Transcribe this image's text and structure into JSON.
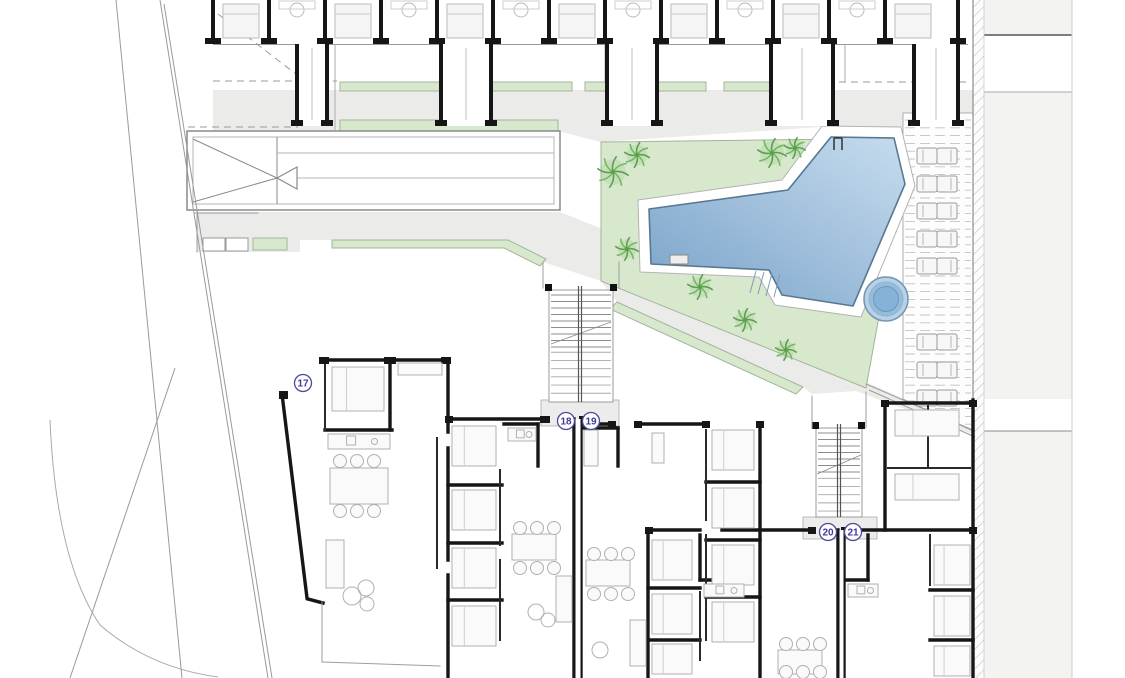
{
  "plan": {
    "title": "site-floor-plan",
    "unit_labels": [
      {
        "text": "17",
        "x": 303,
        "y": 383
      },
      {
        "text": "18",
        "x": 566,
        "y": 421
      },
      {
        "text": "19",
        "x": 591,
        "y": 421
      },
      {
        "text": "20",
        "x": 828,
        "y": 532
      },
      {
        "text": "21",
        "x": 853,
        "y": 532
      }
    ],
    "palette": {
      "plaza": "#ebebe9",
      "green": "#d7e8cd",
      "greenEdge": "#a3b49c",
      "poolDark": "#79a2c9",
      "poolLight": "#c6dcee",
      "poolEdge": "#587891",
      "spaFill": "#b7d2e7",
      "spaMid": "#95bcda",
      "spaCore": "#86b2d8",
      "spaEdge": "#7396b2",
      "wall": "#161616",
      "wallMed": "#2a2a2a",
      "furn": "#b0b0b0",
      "light": "#9e9e9e",
      "hatch": "#c4c4c4",
      "panel": "#f3f3f1",
      "labelInk": "#3c3c96",
      "labelRing": "#4949a0",
      "palm": "#74b862",
      "palmDark": "#5d9e4f",
      "dash": "#9a9a9a",
      "deckLine": "#c2c2c2"
    },
    "plaza_polys": [
      [
        [
          213,
          90
        ],
        [
          973,
          90
        ],
        [
          973,
          113
        ],
        [
          903,
          113
        ],
        [
          903,
          127
        ],
        [
          820,
          127
        ],
        [
          601,
          142
        ],
        [
          558,
          131
        ],
        [
          558,
          120
        ],
        [
          340,
          120
        ],
        [
          340,
          131
        ],
        [
          213,
          131
        ]
      ],
      [
        [
          197,
          212
        ],
        [
          560,
          212
        ],
        [
          610,
          232
        ],
        [
          868,
          383
        ],
        [
          972,
          428
        ],
        [
          972,
          434
        ],
        [
          856,
          391
        ],
        [
          812,
          394
        ],
        [
          803,
          387
        ],
        [
          617,
          302
        ],
        [
          601,
          281
        ],
        [
          543,
          262
        ],
        [
          508,
          248
        ],
        [
          332,
          240
        ],
        [
          300,
          240
        ],
        [
          300,
          252
        ],
        [
          197,
          252
        ]
      ]
    ],
    "green_polys": [
      [
        [
          601,
          142
        ],
        [
          850,
          139
        ],
        [
          882,
          300
        ],
        [
          866,
          388
        ],
        [
          601,
          281
        ]
      ],
      [
        [
          617,
          302
        ],
        [
          803,
          387
        ],
        [
          796,
          394
        ],
        [
          610,
          309
        ]
      ],
      [
        [
          332,
          240
        ],
        [
          508,
          240
        ],
        [
          546,
          259
        ],
        [
          540,
          266
        ],
        [
          504,
          248
        ],
        [
          332,
          248
        ]
      ]
    ],
    "green_rects": [
      [
        253,
        238,
        34,
        12
      ],
      [
        340,
        82,
        100,
        9
      ],
      [
        462,
        82,
        110,
        9
      ],
      [
        585,
        82,
        121,
        9
      ],
      [
        724,
        82,
        54,
        9
      ],
      [
        340,
        120,
        218,
        11
      ]
    ],
    "ramp": {
      "outer": [
        187,
        131,
        373,
        79
      ],
      "inner": [
        193,
        137,
        361,
        67
      ],
      "vline": 277,
      "hlines": [
        153,
        178
      ],
      "tri": [
        [
          193,
          139
        ],
        [
          277,
          178
        ],
        [
          193,
          202
        ]
      ],
      "arrow": [
        [
          277,
          178
        ],
        [
          297,
          167
        ],
        [
          297,
          189
        ]
      ]
    },
    "park_rects": [
      [
        203,
        238,
        22,
        13
      ],
      [
        226,
        238,
        22,
        13
      ]
    ],
    "pool": {
      "apron": [
        [
          822,
          126
        ],
        [
          901,
          127
        ],
        [
          915,
          186
        ],
        [
          861,
          317
        ],
        [
          775,
          305
        ],
        [
          759,
          277
        ],
        [
          640,
          272
        ],
        [
          638,
          200
        ],
        [
          782,
          180
        ]
      ],
      "body": [
        [
          831,
          137
        ],
        [
          894,
          138
        ],
        [
          905,
          184
        ],
        [
          853,
          306
        ],
        [
          782,
          295
        ],
        [
          769,
          270
        ],
        [
          651,
          264
        ],
        [
          649,
          209
        ],
        [
          788,
          190
        ]
      ],
      "steps": [
        [
          756,
          271,
          750,
          293
        ],
        [
          764,
          272,
          758,
          294
        ],
        [
          772,
          273,
          766,
          296
        ],
        [
          780,
          274,
          774,
          297
        ]
      ],
      "rail": {
        "x": 834,
        "y": 138,
        "w": 8,
        "h": 12
      },
      "bench": [
        670,
        255,
        18,
        9
      ]
    },
    "spa": {
      "cx": 886,
      "cy": 299,
      "r1": 22,
      "r2": 17,
      "r3": 12.5
    },
    "deck": {
      "poly": [
        [
          903,
          113
        ],
        [
          973,
          113
        ],
        [
          973,
          431
        ],
        [
          903,
          399
        ]
      ],
      "dashTop": 120,
      "dashBot": 428,
      "dashStep": 7.8,
      "loungerRows": [
        148,
        176,
        203,
        231,
        258,
        334,
        362,
        390
      ],
      "loungerX": 917
    },
    "hatch_strip": {
      "x": 973,
      "y": 0,
      "w": 11,
      "h": 678
    },
    "right_panel": {
      "x": 984,
      "w": 88,
      "whiteBands": [
        [
          35,
          57
        ],
        [
          399,
          32
        ]
      ],
      "lines": [
        {
          "y": 35,
          "x1": 975,
          "x2": 1072,
          "c": "#555",
          "w": 1.4
        },
        {
          "y": 92,
          "x1": 975,
          "x2": 1072,
          "c": "#aaa",
          "w": 1
        },
        {
          "y": 431,
          "x1": 975,
          "x2": 1072,
          "c": "#888",
          "w": 1
        }
      ],
      "vline": 1072
    },
    "boundaries": {
      "lines": [
        [
          116,
          0,
          182,
          678
        ],
        [
          160,
          0,
          268,
          678
        ],
        [
          164,
          4,
          272,
          678
        ],
        [
          175,
          368,
          70,
          678
        ],
        [
          866,
          384,
          975,
          431
        ],
        [
          869,
          390,
          975,
          437
        ]
      ],
      "curve": "M 50,420 Q 56,560 100,625 Q 150,668 218,677"
    },
    "dashed_lines": [
      [
        213,
        81,
        337,
        81
      ],
      [
        779,
        82,
        971,
        82
      ],
      [
        218,
        14,
        301,
        78
      ],
      [
        188,
        127,
        298,
        127
      ]
    ],
    "thin_vlines": [
      [
        335,
        44,
        131
      ],
      [
        455,
        44,
        82
      ],
      [
        605,
        44,
        82
      ],
      [
        788,
        44,
        120
      ],
      [
        845,
        44,
        82
      ]
    ],
    "top_row": {
      "wallXs": [
        213,
        269,
        325,
        381,
        437,
        493,
        549,
        605,
        661,
        717,
        773,
        829,
        885,
        958
      ],
      "wallTop": 0,
      "wallBot": 44,
      "cores": [
        {
          "x": 297,
          "w": 30
        },
        {
          "x": 441,
          "w": 50
        },
        {
          "x": 607,
          "w": 50
        },
        {
          "x": 771,
          "w": 62
        },
        {
          "x": 914,
          "w": 44
        }
      ],
      "coreBot": 126
    },
    "stairs": [
      {
        "x": 549,
        "y": 290,
        "w": 64,
        "h": 112,
        "railX": 580,
        "breakLine": [
          551,
          344,
          611,
          322
        ],
        "stubs": [
          [
            545,
            284
          ],
          [
            610,
            284
          ]
        ],
        "landing": [
          541,
          400,
          78,
          26
        ]
      },
      {
        "x": 816,
        "y": 428,
        "w": 46,
        "h": 89,
        "railX": 839,
        "breakLine": [
          817,
          474,
          861,
          455
        ],
        "stubs": [
          [
            812,
            422
          ],
          [
            858,
            422
          ]
        ],
        "landing": [
          803,
          517,
          74,
          22
        ]
      }
    ],
    "walls_heavy": [
      [
        323,
        360,
        448,
        360
      ],
      [
        448,
        360,
        448,
        432
      ],
      [
        390,
        362,
        390,
        430
      ],
      [
        325,
        430,
        392,
        430
      ],
      [
        282,
        394,
        307,
        598
      ],
      [
        308,
        599,
        323,
        603
      ],
      [
        448,
        448,
        448,
        560
      ],
      [
        448,
        575,
        448,
        678
      ],
      [
        448,
        419,
        545,
        419
      ],
      [
        538,
        424,
        538,
        466
      ],
      [
        504,
        424,
        538,
        424
      ],
      [
        448,
        485,
        502,
        485
      ],
      [
        448,
        543,
        502,
        543
      ],
      [
        448,
        600,
        502,
        600
      ],
      [
        574,
        419,
        574,
        678
      ],
      [
        581,
        419,
        581,
        678
      ],
      [
        582,
        424,
        612,
        424
      ],
      [
        638,
        424,
        706,
        424
      ],
      [
        618,
        428,
        618,
        466
      ],
      [
        582,
        428,
        618,
        428
      ],
      [
        706,
        482,
        760,
        482
      ],
      [
        706,
        540,
        760,
        540
      ],
      [
        706,
        597,
        760,
        597
      ],
      [
        760,
        424,
        760,
        678
      ],
      [
        648,
        530,
        700,
        530
      ],
      [
        722,
        530,
        812,
        530
      ],
      [
        845,
        530,
        973,
        530
      ],
      [
        648,
        530,
        648,
        678
      ],
      [
        838,
        530,
        838,
        678
      ],
      [
        844,
        530,
        844,
        678
      ],
      [
        973,
        400,
        973,
        678
      ],
      [
        885,
        403,
        973,
        403
      ],
      [
        885,
        403,
        885,
        530
      ],
      [
        700,
        535,
        700,
        580
      ],
      [
        700,
        580,
        740,
        580
      ],
      [
        648,
        588,
        700,
        588
      ],
      [
        648,
        640,
        700,
        640
      ],
      [
        868,
        535,
        868,
        580
      ],
      [
        845,
        580,
        868,
        580
      ],
      [
        930,
        590,
        973,
        590
      ],
      [
        930,
        640,
        973,
        640
      ]
    ],
    "walls_med": [
      [
        325,
        362,
        325,
        430
      ],
      [
        437,
        438,
        437,
        568
      ],
      [
        500,
        470,
        500,
        545
      ],
      [
        500,
        560,
        500,
        640
      ],
      [
        706,
        430,
        706,
        520
      ],
      [
        706,
        535,
        706,
        640
      ],
      [
        888,
        468,
        970,
        468
      ],
      [
        928,
        406,
        928,
        466
      ],
      [
        700,
        592,
        700,
        660
      ],
      [
        930,
        535,
        930,
        585
      ]
    ],
    "wall_stubs": [
      [
        319,
        357,
        10,
        7
      ],
      [
        384,
        357,
        12,
        7
      ],
      [
        441,
        357,
        10,
        7
      ],
      [
        279,
        391,
        9,
        8
      ],
      [
        445,
        416,
        8,
        7
      ],
      [
        540,
        416,
        10,
        7
      ],
      [
        579,
        416,
        8,
        7
      ],
      [
        608,
        421,
        8,
        7
      ],
      [
        634,
        421,
        8,
        7
      ],
      [
        702,
        421,
        8,
        7
      ],
      [
        756,
        421,
        8,
        7
      ],
      [
        645,
        527,
        8,
        7
      ],
      [
        808,
        527,
        8,
        7
      ],
      [
        841,
        527,
        8,
        7
      ],
      [
        969,
        527,
        8,
        7
      ],
      [
        881,
        400,
        8,
        7
      ],
      [
        969,
        400,
        8,
        7
      ]
    ],
    "furniture": {
      "beds": [
        [
          332,
          367,
          52,
          44
        ],
        [
          452,
          426,
          44,
          40
        ],
        [
          452,
          490,
          44,
          40
        ],
        [
          452,
          548,
          44,
          40
        ],
        [
          452,
          606,
          44,
          40
        ],
        [
          712,
          430,
          42,
          40
        ],
        [
          712,
          488,
          42,
          40
        ],
        [
          712,
          545,
          42,
          40
        ],
        [
          712,
          602,
          42,
          40
        ],
        [
          652,
          540,
          40,
          40
        ],
        [
          652,
          594,
          40,
          40
        ],
        [
          652,
          644,
          40,
          30
        ],
        [
          895,
          410,
          64,
          26
        ],
        [
          895,
          474,
          64,
          26
        ],
        [
          934,
          545,
          36,
          40
        ],
        [
          934,
          596,
          36,
          40
        ],
        [
          934,
          646,
          36,
          30
        ]
      ],
      "tables": [
        [
          330,
          468,
          58,
          36
        ],
        [
          512,
          534,
          44,
          26
        ],
        [
          586,
          560,
          44,
          26
        ],
        [
          778,
          650,
          44,
          24
        ]
      ],
      "chair_grids": [
        {
          "cx": [
            340,
            357,
            374
          ],
          "cy": [
            461,
            511
          ]
        },
        {
          "cx": [
            520,
            537,
            554
          ],
          "cy": [
            528,
            568
          ]
        },
        {
          "cx": [
            594,
            611,
            628
          ],
          "cy": [
            554,
            594
          ]
        },
        {
          "cx": [
            786,
            803,
            820
          ],
          "cy": [
            644,
            672
          ]
        }
      ],
      "sofas": [
        [
          326,
          540,
          18,
          48
        ],
        [
          556,
          576,
          16,
          46
        ],
        [
          630,
          620,
          16,
          46
        ]
      ],
      "counters": [
        [
          328,
          434,
          62,
          15
        ],
        [
          508,
          428,
          28,
          13
        ],
        [
          584,
          430,
          14,
          36
        ],
        [
          704,
          584,
          40,
          13
        ],
        [
          848,
          584,
          30,
          13
        ]
      ],
      "plants": [
        [
          352,
          596,
          9
        ],
        [
          366,
          588,
          8
        ],
        [
          367,
          604,
          7
        ],
        [
          536,
          612,
          8
        ],
        [
          548,
          620,
          7
        ],
        [
          600,
          650,
          8
        ]
      ],
      "dressers": [
        [
          398,
          363,
          44,
          12
        ],
        [
          652,
          433,
          12,
          30
        ]
      ]
    },
    "misc_lines_light": [
      [
        322,
        602,
        322,
        662
      ],
      [
        322,
        662,
        440,
        666
      ],
      [
        197,
        212,
        197,
        252
      ],
      [
        195,
        213,
        258,
        213
      ],
      [
        812,
        396,
        812,
        428
      ],
      [
        866,
        392,
        866,
        428
      ],
      [
        543,
        262,
        543,
        288
      ],
      [
        619,
        262,
        619,
        288
      ]
    ]
  }
}
